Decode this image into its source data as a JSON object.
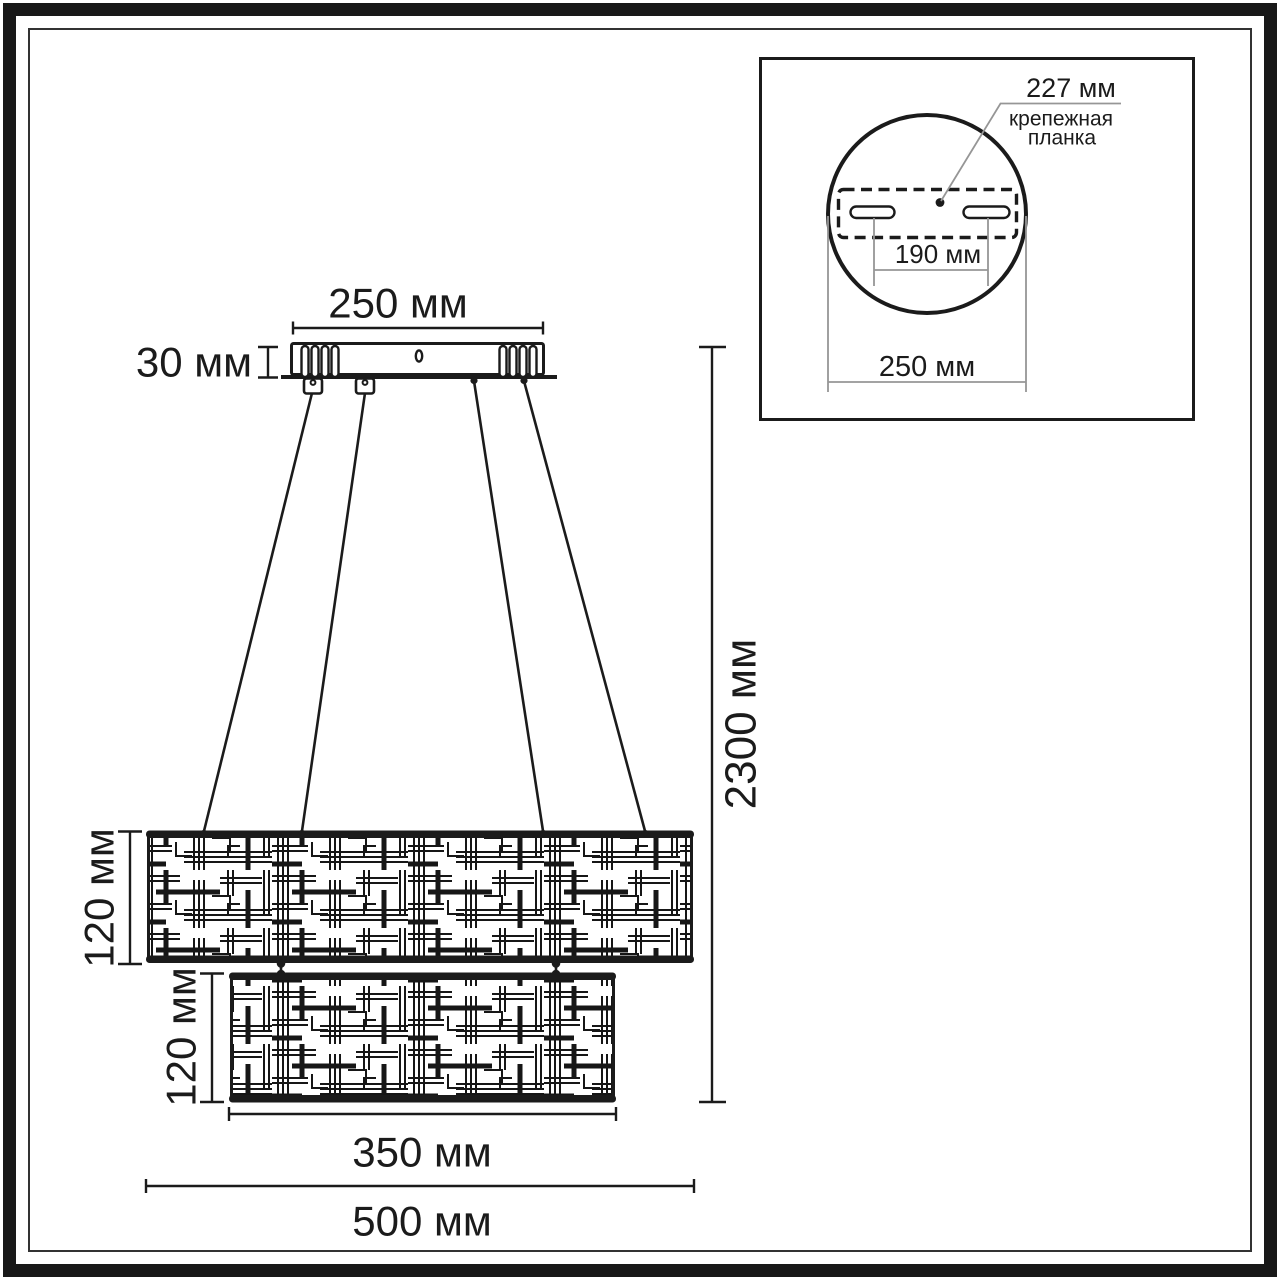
{
  "colors": {
    "ink": "#1b1b1b",
    "gray": "#969696",
    "paper": "#ffffff"
  },
  "main_view": {
    "canopy_width_label": "250 мм",
    "canopy_height_label": "30 мм",
    "overall_drop_label": "2300 мм",
    "tier1_height_label": "120 мм",
    "tier2_height_label": "120 мм",
    "tier2_width_label": "350 мм",
    "tier1_width_label": "500 мм"
  },
  "inset": {
    "plate_length_label": "227 мм",
    "plate_caption_line1": "крепежная",
    "plate_caption_line2": "планка",
    "slot_spacing_label": "190 мм",
    "base_width_label": "250 мм"
  }
}
